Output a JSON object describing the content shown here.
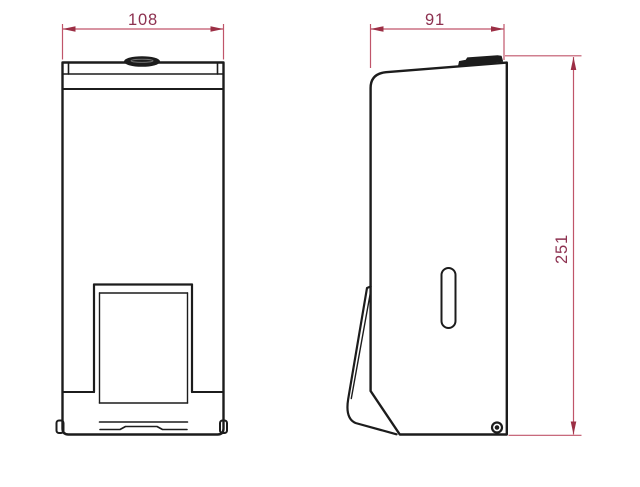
{
  "dimensions": {
    "front_width": "108",
    "side_depth": "91",
    "side_height": "251"
  },
  "colors": {
    "outline": "#1c1c1c",
    "dimension_line": "#c0556a",
    "dimension_arrow": "#9c2f45",
    "dimension_text": "#8d3150",
    "background": "#ffffff"
  }
}
